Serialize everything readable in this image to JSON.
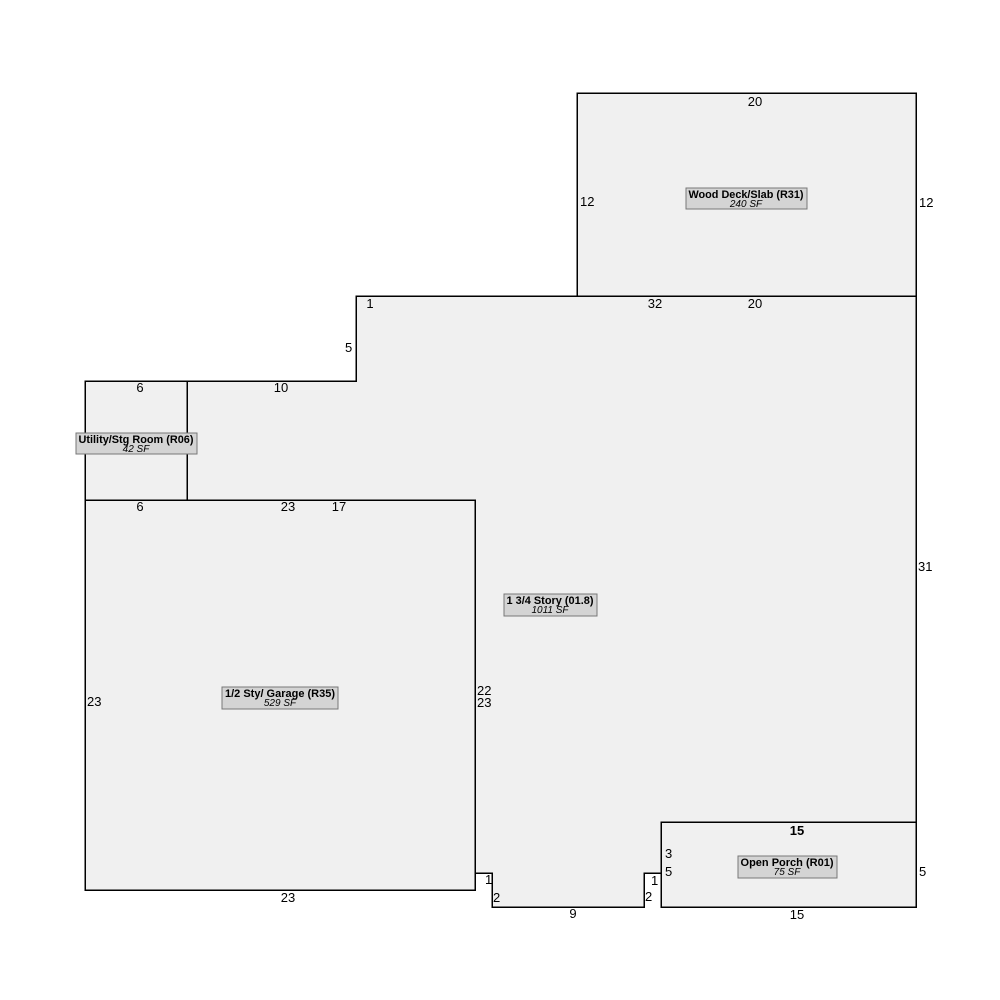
{
  "colors": {
    "background": "#ffffff",
    "region_fill": "#f0f0f0",
    "outline": "#000000",
    "label_box_fill": "#d4d4d4",
    "label_box_border": "#777777",
    "text": "#000000"
  },
  "regions": {
    "wood_deck": {
      "label": "Wood Deck/Slab (R31)",
      "area": "240 SF"
    },
    "main_story": {
      "label": "1 3/4 Story (01.8)",
      "area": "1011 SF"
    },
    "utility": {
      "label": "Utility/Stg Room (R06)",
      "area": "42 SF"
    },
    "garage": {
      "label": "1/2 Sty/ Garage (R35)",
      "area": "529 SF"
    },
    "porch": {
      "label": "Open Porch (R01)",
      "area": "75 SF"
    }
  },
  "dims": {
    "deck_top": "20",
    "deck_left": "12",
    "deck_right": "12",
    "deck_bottom": "20",
    "main_top_a": "1",
    "main_top_b": "32",
    "main_left_upper": "5",
    "main_upper_left": "10",
    "utility_top": "6",
    "utility_bottom": "6",
    "garage_top": "23",
    "main_garage_shared": "17",
    "garage_left": "23",
    "garage_right": "23",
    "garage_bottom": "23",
    "main_left_mid": "22",
    "main_right": "31",
    "step_left_1": "1",
    "step_left_2": "2",
    "notch_bottom": "9",
    "step_right_2": "2",
    "step_right_1": "1",
    "porch_left_3": "3",
    "porch_left_5": "5",
    "porch_top": "15",
    "porch_right": "5",
    "porch_bottom": "15"
  }
}
